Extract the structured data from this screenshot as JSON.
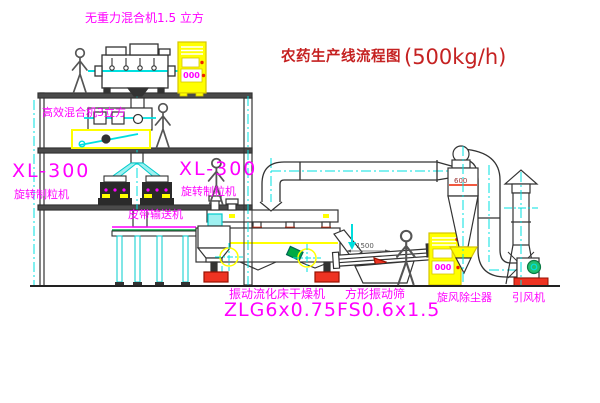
{
  "diagram": {
    "title": {
      "name": "农药生产线流程图",
      "capacity": "(500kg/h)"
    },
    "equipment_labels": {
      "gravity_mixer": "无重力混合机1.5 立方",
      "high_efficiency_mixer": "高效混合机3立方",
      "granulator_1": {
        "model": "XL-300",
        "name": "旋转制粒机"
      },
      "granulator_2": {
        "model": "XL-300",
        "name": "旋转制粒机"
      },
      "belt_conveyor": "皮带输送机",
      "fluid_bed_dryer": {
        "name": "振动流化床干燥机",
        "model": "ZLG6x0.75"
      },
      "vibrating_screen": {
        "name": "方形振动筛",
        "model": "FS0.6x1.5"
      },
      "cyclone": "旋风除尘器",
      "induced_draft_fan": "引风机"
    },
    "small_texts": {
      "panel_1_display": "000",
      "panel_2_display": "000",
      "screen_dimension": "1500",
      "cyclone_dimension": "600"
    },
    "colors": {
      "background": "#FFFFFF",
      "label_magenta": "#FF00FF",
      "title_red": "#C52222",
      "equipment_yellow": "#FFFF00",
      "centerline_cyan": "#00E0E0",
      "accent_red": "#EE2200",
      "conveyor_green": "#00AA44",
      "line_dark": "#333333"
    }
  }
}
